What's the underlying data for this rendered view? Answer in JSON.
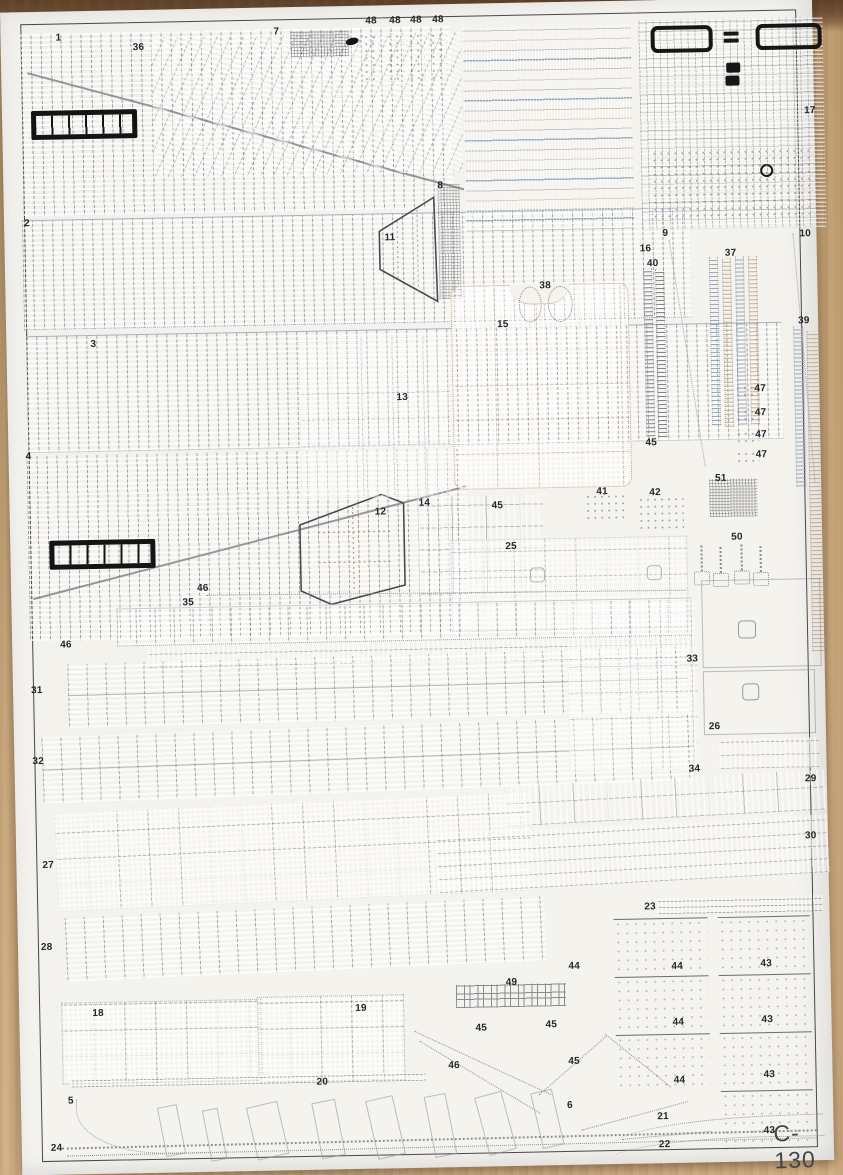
{
  "sheet": {
    "kit_title": "C-130",
    "description": "paper model parts sheet",
    "part_labels": [
      {
        "t": "1",
        "x": 55,
        "y": 21
      },
      {
        "t": "36",
        "x": 132,
        "y": 32
      },
      {
        "t": "7",
        "x": 273,
        "y": 19
      },
      {
        "t": "48",
        "x": 365,
        "y": 10
      },
      {
        "t": "48",
        "x": 389,
        "y": 10
      },
      {
        "t": "48",
        "x": 410,
        "y": 10
      },
      {
        "t": "48",
        "x": 432,
        "y": 10
      },
      {
        "t": "17",
        "x": 802,
        "y": 108
      },
      {
        "t": "2",
        "x": 20,
        "y": 206
      },
      {
        "t": "8",
        "x": 434,
        "y": 176
      },
      {
        "t": "11",
        "x": 380,
        "y": 227
      },
      {
        "t": "9",
        "x": 658,
        "y": 228
      },
      {
        "t": "10",
        "x": 795,
        "y": 231
      },
      {
        "t": "16",
        "x": 635,
        "y": 243
      },
      {
        "t": "40",
        "x": 642,
        "y": 258
      },
      {
        "t": "37",
        "x": 720,
        "y": 249
      },
      {
        "t": "39",
        "x": 792,
        "y": 318
      },
      {
        "t": "3",
        "x": 84,
        "y": 328
      },
      {
        "t": "15",
        "x": 491,
        "y": 316
      },
      {
        "t": "38",
        "x": 534,
        "y": 278
      },
      {
        "t": "13",
        "x": 389,
        "y": 387
      },
      {
        "t": "47",
        "x": 747,
        "y": 385
      },
      {
        "t": "47",
        "x": 747,
        "y": 409
      },
      {
        "t": "47",
        "x": 747,
        "y": 431
      },
      {
        "t": "47",
        "x": 747,
        "y": 451
      },
      {
        "t": "45",
        "x": 637,
        "y": 437
      },
      {
        "t": "4",
        "x": 17,
        "y": 439
      },
      {
        "t": "51",
        "x": 706,
        "y": 474
      },
      {
        "t": "41",
        "x": 587,
        "y": 485
      },
      {
        "t": "42",
        "x": 640,
        "y": 487
      },
      {
        "t": "14",
        "x": 409,
        "y": 493
      },
      {
        "t": "45",
        "x": 482,
        "y": 497
      },
      {
        "t": "12",
        "x": 365,
        "y": 501
      },
      {
        "t": "25",
        "x": 495,
        "y": 538
      },
      {
        "t": "50",
        "x": 721,
        "y": 533
      },
      {
        "t": "46",
        "x": 186,
        "y": 574
      },
      {
        "t": "35",
        "x": 171,
        "y": 588
      },
      {
        "t": "46",
        "x": 48,
        "y": 628
      },
      {
        "t": "31",
        "x": 18,
        "y": 673
      },
      {
        "t": "33",
        "x": 674,
        "y": 654
      },
      {
        "t": "32",
        "x": 18,
        "y": 744
      },
      {
        "t": "26",
        "x": 695,
        "y": 722
      },
      {
        "t": "34",
        "x": 674,
        "y": 764
      },
      {
        "t": "29",
        "x": 790,
        "y": 776
      },
      {
        "t": "30",
        "x": 789,
        "y": 833
      },
      {
        "t": "27",
        "x": 26,
        "y": 848
      },
      {
        "t": "28",
        "x": 23,
        "y": 930
      },
      {
        "t": "23",
        "x": 627,
        "y": 901
      },
      {
        "t": "44",
        "x": 550,
        "y": 959
      },
      {
        "t": "44",
        "x": 653,
        "y": 961
      },
      {
        "t": "43",
        "x": 742,
        "y": 960
      },
      {
        "t": "18",
        "x": 73,
        "y": 997
      },
      {
        "t": "19",
        "x": 336,
        "y": 997
      },
      {
        "t": "49",
        "x": 487,
        "y": 974
      },
      {
        "t": "45",
        "x": 456,
        "y": 1019
      },
      {
        "t": "45",
        "x": 526,
        "y": 1017
      },
      {
        "t": "44",
        "x": 653,
        "y": 1017
      },
      {
        "t": "43",
        "x": 742,
        "y": 1016
      },
      {
        "t": "46",
        "x": 428,
        "y": 1056
      },
      {
        "t": "45",
        "x": 548,
        "y": 1054
      },
      {
        "t": "20",
        "x": 296,
        "y": 1070
      },
      {
        "t": "44",
        "x": 653,
        "y": 1075
      },
      {
        "t": "43",
        "x": 743,
        "y": 1071
      },
      {
        "t": "5",
        "x": 47,
        "y": 1084
      },
      {
        "t": "6",
        "x": 546,
        "y": 1098
      },
      {
        "t": "21",
        "x": 636,
        "y": 1111
      },
      {
        "t": "43",
        "x": 742,
        "y": 1127
      },
      {
        "t": "22",
        "x": 637,
        "y": 1139
      },
      {
        "t": "24",
        "x": 29,
        "y": 1131
      }
    ]
  },
  "colors": {
    "paper": "#f5f3ee",
    "wood": "#c9a87c",
    "wood_dark": "#6e4f33",
    "ink": "#26262b",
    "blue_line": "#8ba4ba",
    "tan_line": "#c9b094",
    "frame": "#47474d",
    "black_part": "#161616"
  }
}
